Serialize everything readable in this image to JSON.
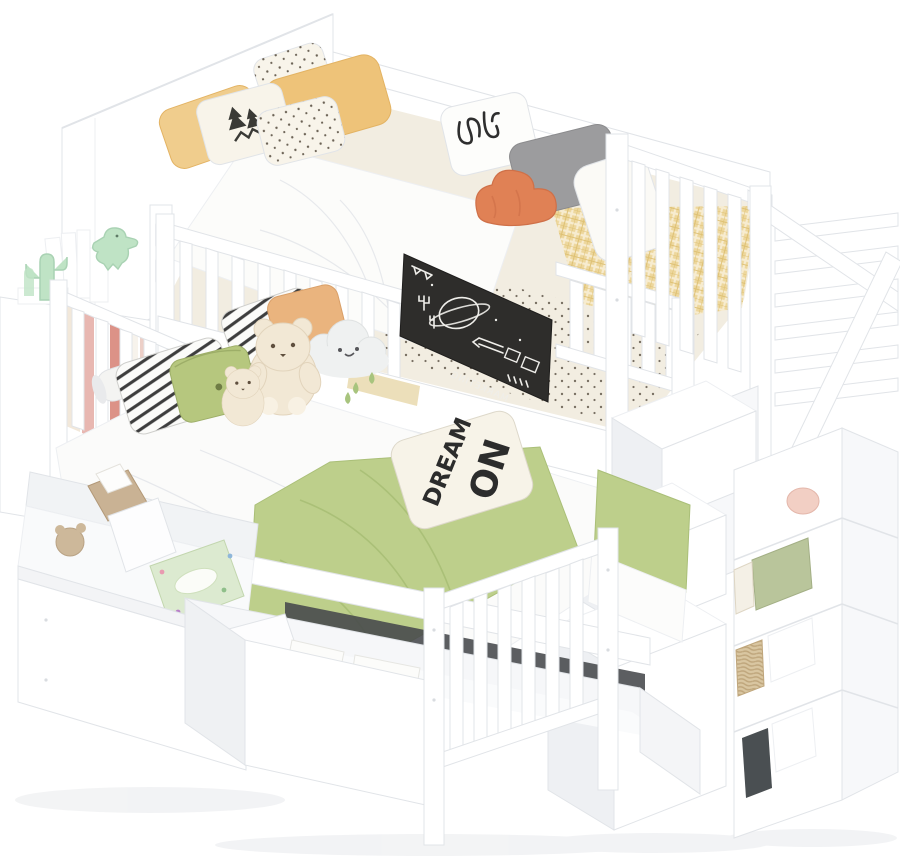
{
  "scene": {
    "type": "product-photo",
    "subject": "White twin-over-full bunk bed with storage staircase, bookshelf tower and under-bed drawers, decorated with pillows and plush toys",
    "background": "#ffffff"
  },
  "texts": {
    "dream_pillow_line1": "DREAM",
    "dream_pillow_line2": "ON",
    "chalkboard_word": "MARKETING"
  },
  "objects": [
    "headboard-cabinet",
    "bookshelf-tower",
    "cactus-bookend",
    "dinosaur-figurine",
    "shelf-books",
    "top-bunk",
    "guardrail",
    "chalkboard",
    "yellow-checkered-blanket",
    "polka-dot-sheet",
    "duvet",
    "yellow-pillows",
    "pine-tree-pillow",
    "dotted-pillows",
    "scribble-pillow",
    "gray-pillow",
    "orange-cloud-plush",
    "white-pillow",
    "bottom-bunk",
    "striped-pillows",
    "green-button-pillow",
    "teddy-bear-large",
    "teddy-bear-small",
    "cloud-plush",
    "bolster-pillow",
    "green-blanket",
    "dream-pillow",
    "underbed-drawer-1",
    "underbed-drawer-2",
    "wicker-basket",
    "tissue-box",
    "storage-boxes",
    "staircase",
    "staircase-handrail",
    "storage-cubby-column"
  ],
  "colors": {
    "edge": "#e1e4e8",
    "edge_soft": "#edeff2",
    "panel_tint": "#f7f8fa",
    "shade": "#eef0f3",
    "shadow": "#f0f1f3",
    "slot_dark": "#45484b",
    "chalkboard": "#2e2d2b",
    "chalk": "#efeeea",
    "sheet_cream": "#f2ede1",
    "dot_brown": "#6b6255",
    "duvet_white": "#fcfcfa",
    "blanket_yellow": "#edd79d",
    "blanket_yellow_line": "#dcbd6d",
    "pillow_yellow": "#f0cd8d",
    "pillow_yellow_deep": "#eec379",
    "pillow_cream": "#f8f4ea",
    "pillow_gray": "#9c9c9e",
    "plush_orange": "#e08155",
    "pillow_tan": "#eab47e",
    "stripe_dark": "#3d3d3d",
    "pillow_green": "#b6c77e",
    "blanket_green": "#bdcf8b",
    "blanket_green_deep": "#a3b96f",
    "bear_cream": "#f2e8d5",
    "bear_face": "#5f4f3e",
    "cloud_gray": "#eff1f1",
    "mint": "#bfe3c5",
    "basket_tan": "#d9c6a1",
    "basket_line": "#bfa67c",
    "wood_tan": "#c9b294",
    "tissue_green": "#dcead0",
    "book_pink": "#e8b7b1",
    "book_red": "#dc9287",
    "ink": "#2c2c2c",
    "navy": "#2e3d66",
    "dark_green_book": "#3f4a42"
  }
}
